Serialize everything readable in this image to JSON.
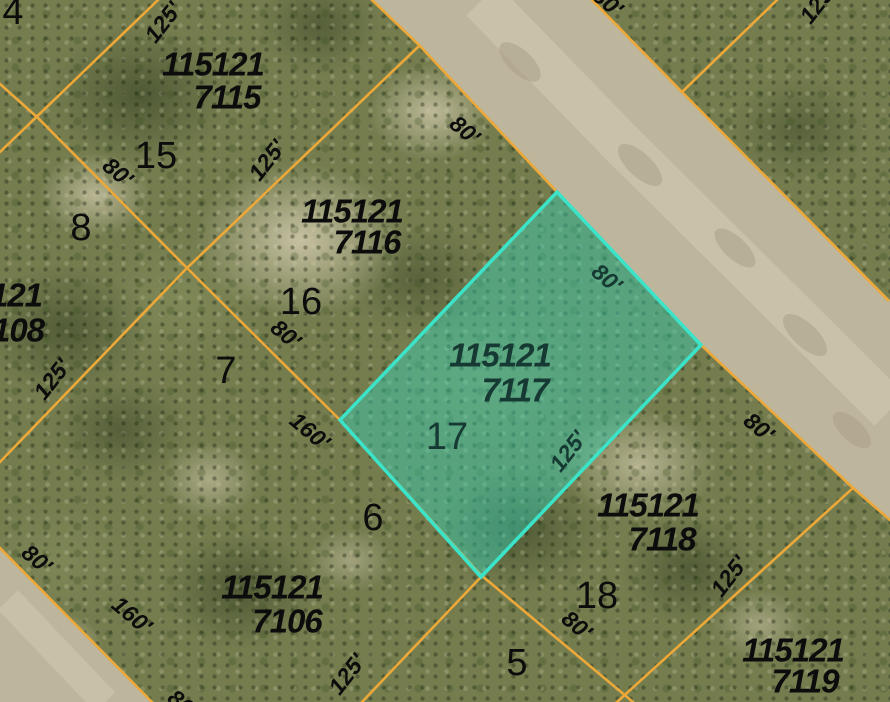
{
  "colors": {
    "boundary_orange": "#ECA838",
    "highlight_fill": "#2FD9BE",
    "highlight_stroke": "#3BE4C9",
    "highlight_text": "#163A33",
    "parcel_text": "#0C0C0C",
    "road_fill": "#BEB59D",
    "road_stripe": "#CCC5AC",
    "ground_base": "#757D4F"
  },
  "highlighted_parcel": {
    "parcel_id": "115121 7117",
    "lot_number": "17"
  },
  "labels": [
    {
      "text": "4",
      "kind": "lot-number"
    },
    {
      "text": "125'",
      "kind": "dimension"
    },
    {
      "text": "115121",
      "kind": "parcel-id"
    },
    {
      "text": "7115",
      "kind": "parcel-id"
    },
    {
      "text": "15",
      "kind": "lot-number"
    },
    {
      "text": "80'",
      "kind": "dimension"
    },
    {
      "text": "125'",
      "kind": "dimension"
    },
    {
      "text": "8",
      "kind": "lot-number"
    },
    {
      "text": "121",
      "kind": "parcel-id"
    },
    {
      "text": "108",
      "kind": "parcel-id"
    },
    {
      "text": "115121",
      "kind": "parcel-id"
    },
    {
      "text": "7116",
      "kind": "parcel-id"
    },
    {
      "text": "16",
      "kind": "lot-number"
    },
    {
      "text": "80'",
      "kind": "dimension"
    },
    {
      "text": "125'",
      "kind": "dimension"
    },
    {
      "text": "7",
      "kind": "lot-number"
    },
    {
      "text": "160'",
      "kind": "dimension"
    },
    {
      "text": "80'",
      "kind": "dimension"
    },
    {
      "text": "160'",
      "kind": "dimension"
    },
    {
      "text": "115121",
      "kind": "parcel-id"
    },
    {
      "text": "7106",
      "kind": "parcel-id"
    },
    {
      "text": "6",
      "kind": "lot-number"
    },
    {
      "text": "125'",
      "kind": "dimension"
    },
    {
      "text": "5",
      "kind": "lot-number"
    },
    {
      "text": "80'",
      "kind": "dimension"
    },
    {
      "text": "80'",
      "kind": "dimension"
    },
    {
      "text": "125'",
      "kind": "dimension"
    },
    {
      "text": "80'",
      "kind": "dimension-highlight"
    },
    {
      "text": "115121",
      "kind": "parcel-id-highlight"
    },
    {
      "text": "7117",
      "kind": "parcel-id-highlight"
    },
    {
      "text": "17",
      "kind": "lot-number-highlight"
    },
    {
      "text": "125'",
      "kind": "dimension-highlight"
    },
    {
      "text": "115121",
      "kind": "parcel-id"
    },
    {
      "text": "7118",
      "kind": "parcel-id"
    },
    {
      "text": "18",
      "kind": "lot-number"
    },
    {
      "text": "80'",
      "kind": "dimension"
    },
    {
      "text": "125'",
      "kind": "dimension"
    },
    {
      "text": "80'",
      "kind": "dimension"
    },
    {
      "text": "115121",
      "kind": "parcel-id"
    },
    {
      "text": "7119",
      "kind": "parcel-id"
    },
    {
      "text": "80'",
      "kind": "dimension"
    }
  ]
}
